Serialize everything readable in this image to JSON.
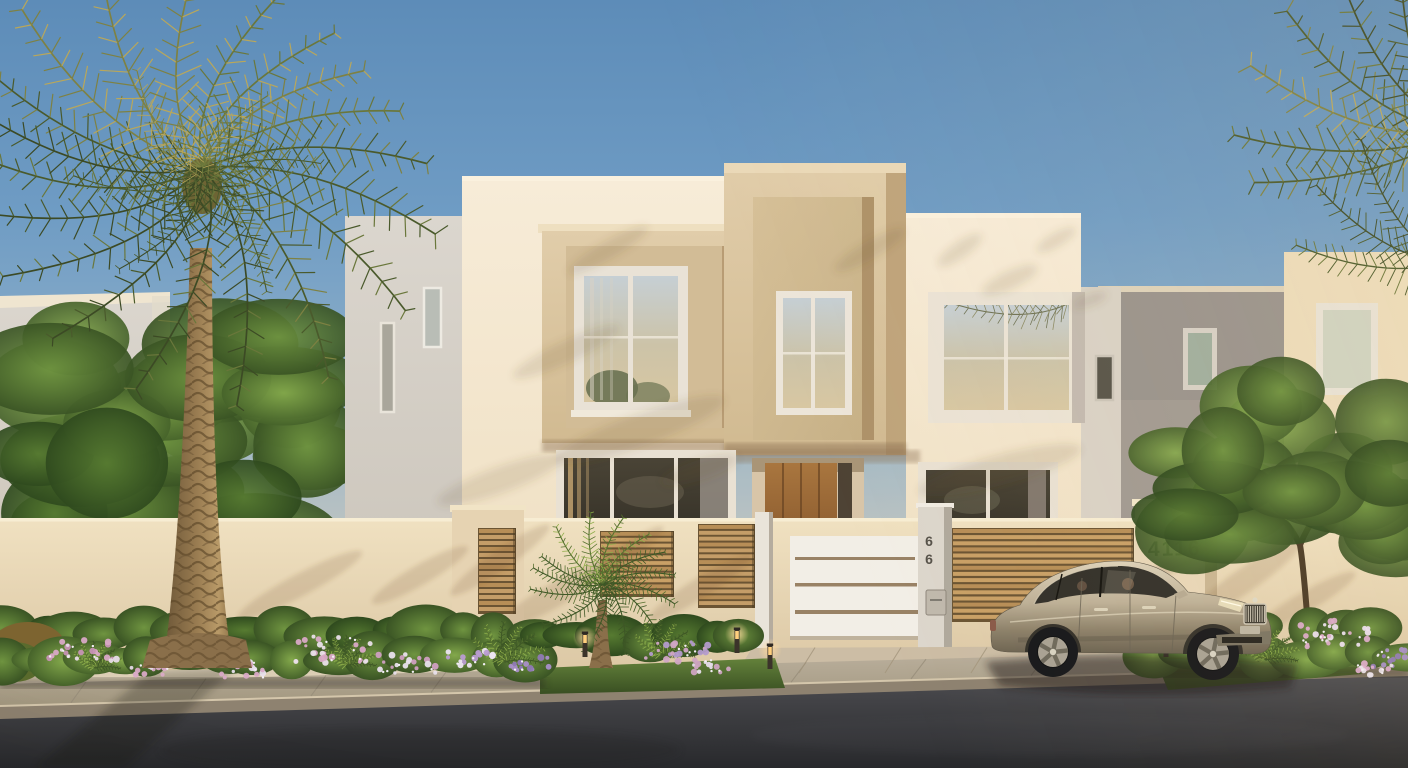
{
  "scene": {
    "house_number": "4116",
    "gate_unit_number": "66"
  },
  "palette": {
    "sky_top": "#5d8cb8",
    "sky_horizon": "#e7d8bc",
    "facade_lit": "#f5e8d1",
    "facade_shaded": "#d6d1c9",
    "accent_beige": "#d9c4a0",
    "tower_panel": "#cdb78f",
    "perimeter_wall": "#ecdcbd",
    "wood_slats": "#c49d68",
    "gate_white": "#f2eee6",
    "door_wood": "#8a5c33",
    "window_frame_white": "#ebe3d5",
    "glass_reflection": "#ccc3a8",
    "grass": "#5a7733",
    "bush_green": "#44602b",
    "flower_pink": "#d9a9c6",
    "flower_lavender": "#a98fc8",
    "palm_frond_lit": "#b9a75a",
    "palm_frond_dark": "#4a5a2c",
    "palm_trunk": "#96794f",
    "car_body": "#bdb097",
    "bollard_glow": "#ffcf7e",
    "driveway": "#ccbda5",
    "sidewalk": "#b3a896",
    "asphalt": "#3a3b3e"
  }
}
